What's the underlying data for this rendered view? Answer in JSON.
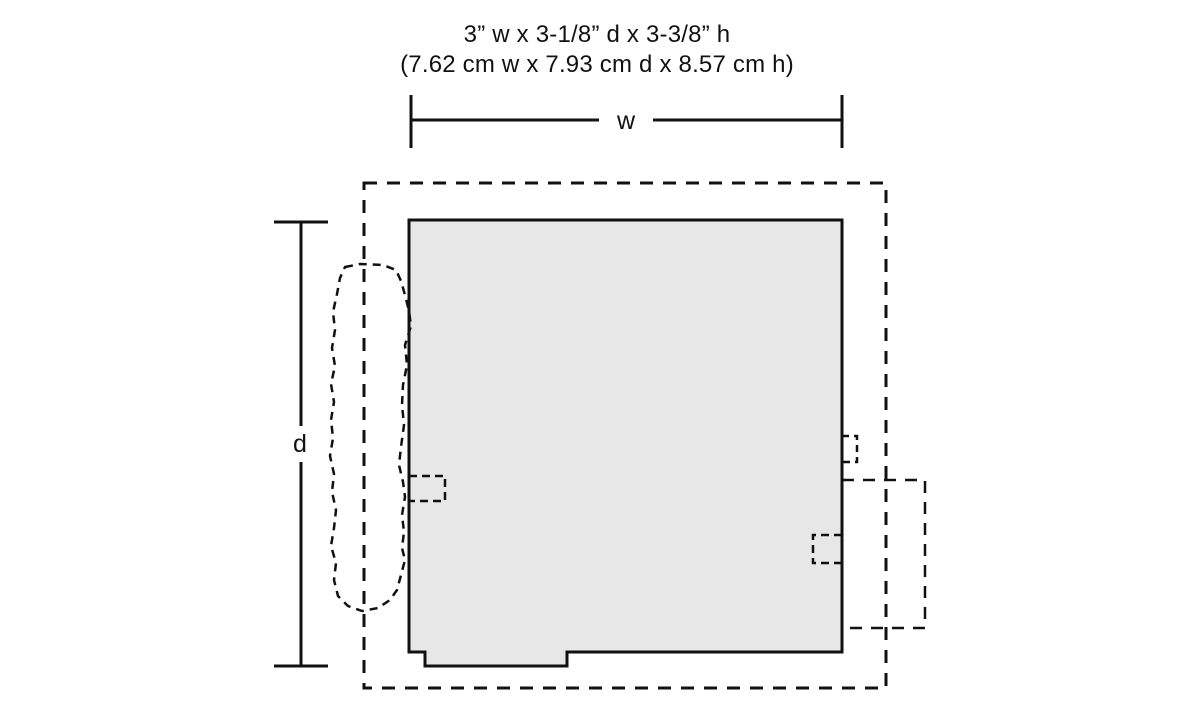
{
  "title": {
    "line1": "3” w x 3-1/8” d x 3-3/8” h",
    "line2": "(7.62 cm w x 7.93 cm d x 8.57 cm h)"
  },
  "dimensions": {
    "width": {
      "inches": "3”",
      "cm": "7.62 cm"
    },
    "depth": {
      "inches": "3-1/8”",
      "cm": "7.93 cm"
    },
    "height": {
      "inches": "3-3/8”",
      "cm": "8.57 cm"
    }
  },
  "labels": {
    "width": "w",
    "depth": "d"
  },
  "colors": {
    "background": "#ffffff",
    "line": "#111111",
    "footprint_fill": "#e7e7e7"
  }
}
